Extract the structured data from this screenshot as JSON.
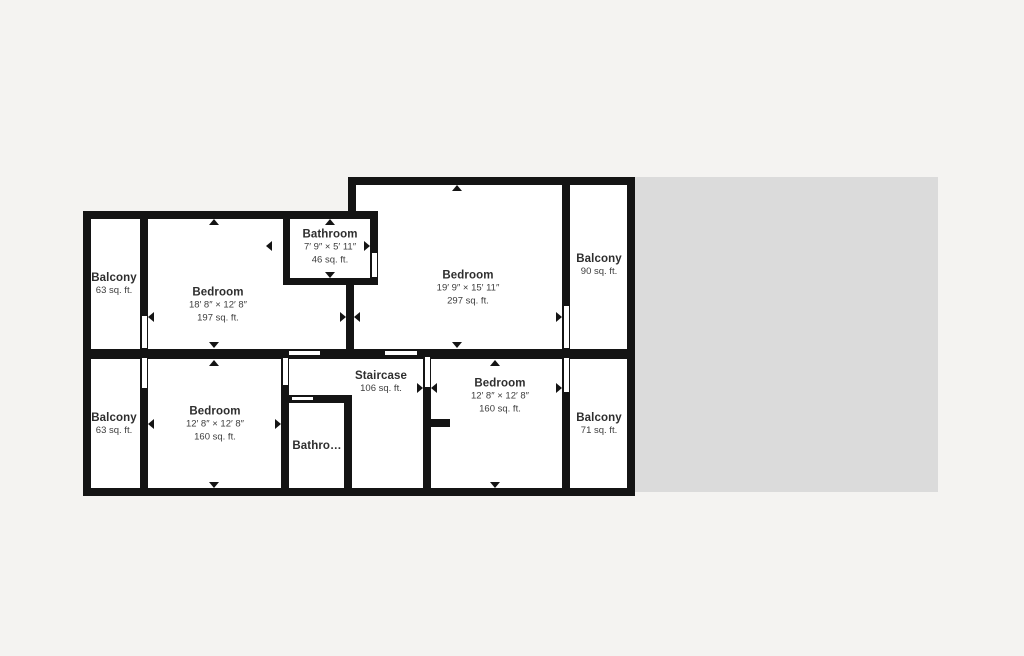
{
  "plan": {
    "title": "Second floor plan",
    "rooms": {
      "balcony_tl": {
        "name": "Balcony",
        "area": "63 sq. ft."
      },
      "bedroom_tl": {
        "name": "Bedroom",
        "dims": "18′ 8″ × 12′ 8″",
        "area": "197 sq. ft."
      },
      "bathroom_t": {
        "name": "Bathroom",
        "dims": "7′ 9″ × 5′ 11″",
        "area": "46 sq. ft."
      },
      "bedroom_big": {
        "name": "Bedroom",
        "dims": "19′ 9″ × 15′ 11″",
        "area": "297 sq. ft."
      },
      "balcony_tr": {
        "name": "Balcony",
        "area": "90 sq. ft."
      },
      "balcony_bl": {
        "name": "Balcony",
        "area": "63 sq. ft."
      },
      "bedroom_bl": {
        "name": "Bedroom",
        "dims": "12′ 8″ × 12′ 8″",
        "area": "160 sq. ft."
      },
      "bathroom_b": {
        "name": "Bathro…"
      },
      "staircase": {
        "name": "Staircase",
        "area": "106 sq. ft."
      },
      "bedroom_br": {
        "name": "Bedroom",
        "dims": "12′ 8″ × 12′ 8″",
        "area": "160 sq. ft."
      },
      "balcony_br": {
        "name": "Balcony",
        "area": "71 sq. ft."
      }
    },
    "colors": {
      "background": "#f4f3f1",
      "adjacent_area": "#dbdbdb",
      "wall": "#141414",
      "room_fill": "#ffffff",
      "room_name_text": "#2e2e2e",
      "room_sub_text": "#3d3d3d"
    }
  }
}
